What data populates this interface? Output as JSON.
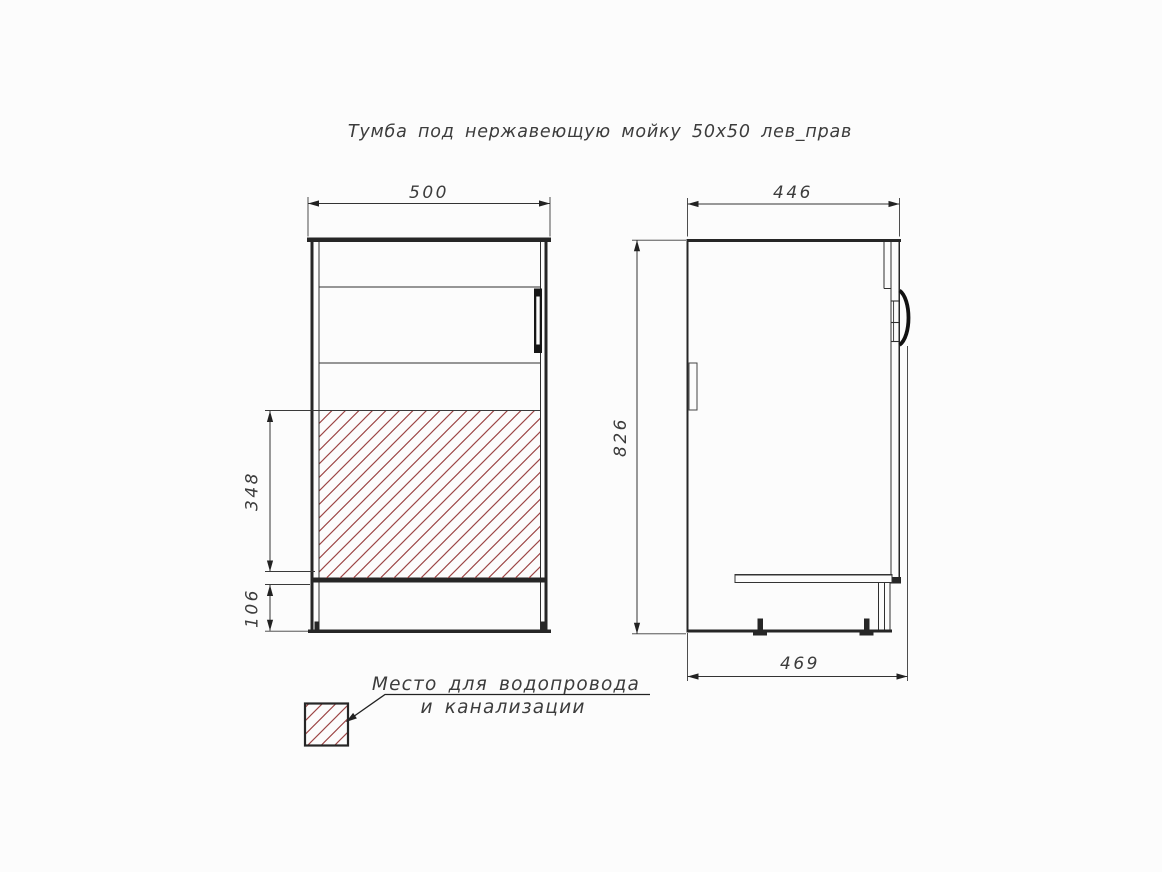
{
  "title": "Тумба под нержавеющую мойку 50x50 лев_прав",
  "front_view": {
    "width_mm": "500",
    "hatch_zone_height_mm": "348",
    "plinth_height_mm": "106"
  },
  "side_view": {
    "depth_mm": "446",
    "height_mm": "826",
    "overall_depth_mm": "469"
  },
  "legend": {
    "note_line1": "Место для водопровода",
    "note_line2": "и канализации"
  },
  "colors": {
    "line": "#262626",
    "hatch_red": "#9c4545",
    "background": "#fcfcfc",
    "text": "#3c3c3c"
  }
}
